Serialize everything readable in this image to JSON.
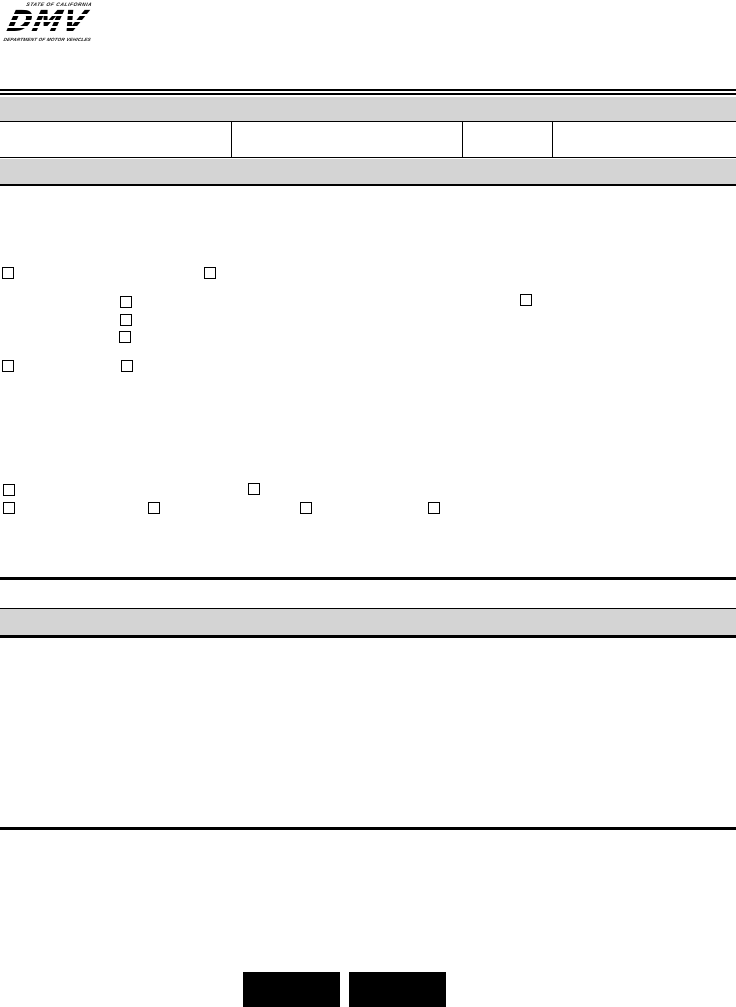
{
  "logo": {
    "state_text": "STATE OF CALIFORNIA",
    "acronym": "DMV",
    "department_text": "DEPARTMENT OF MOTOR VEHICLES"
  },
  "header": {
    "title_bar_text": "",
    "subsection_bar_text": "",
    "section2_bar_text": ""
  },
  "form_row": {
    "cells": [
      "",
      "",
      "",
      ""
    ]
  },
  "checkboxes": {
    "group_a": [
      {
        "id": "cb-a1",
        "checked": false
      },
      {
        "id": "cb-a2",
        "checked": false
      },
      {
        "id": "cb-a3",
        "checked": false
      },
      {
        "id": "cb-a4",
        "checked": false
      },
      {
        "id": "cb-a5",
        "checked": false
      },
      {
        "id": "cb-a6",
        "checked": false
      },
      {
        "id": "cb-a7",
        "checked": false
      },
      {
        "id": "cb-a8",
        "checked": false
      }
    ],
    "group_b": [
      {
        "id": "cb-b1",
        "checked": false
      },
      {
        "id": "cb-b2",
        "checked": false
      },
      {
        "id": "cb-b3",
        "checked": false
      },
      {
        "id": "cb-b4",
        "checked": false
      },
      {
        "id": "cb-b5",
        "checked": false
      },
      {
        "id": "cb-b6",
        "checked": false
      }
    ]
  },
  "buttons": {
    "left_label": "",
    "right_label": ""
  },
  "colors": {
    "bar_gray": "#d4d4d4",
    "line_black": "#000000",
    "button_cyan": "#00dde1",
    "button_cyan_light": "#b2fdfd",
    "button_cyan_dark": "#00c0c4"
  }
}
